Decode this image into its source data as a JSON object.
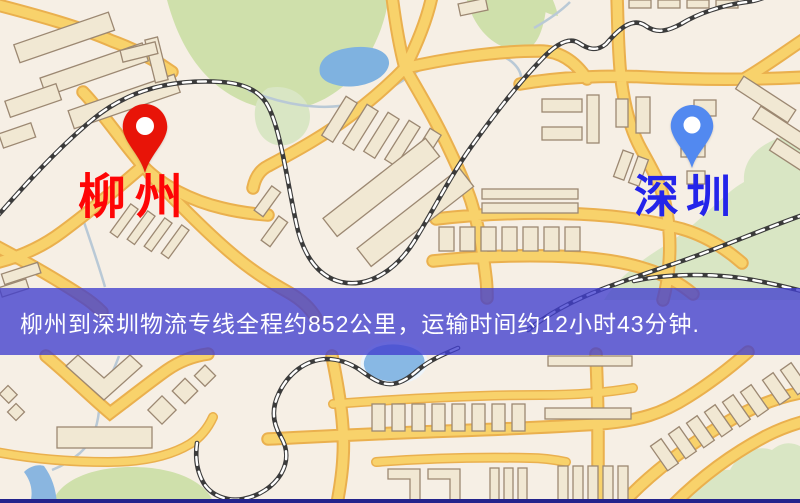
{
  "map": {
    "origin": {
      "label": "柳州",
      "pin_color": "#e81408",
      "label_color": "#fe0505",
      "pin_icon": "red-location-pin-icon"
    },
    "destination": {
      "label": "深圳",
      "pin_color": "#5289f0",
      "label_color": "#2424ea",
      "pin_icon": "blue-location-pin-icon"
    },
    "palette": {
      "background": "#f6efe5",
      "road_fill": "#f8d26b",
      "road_casing": "#eab04e",
      "building_fill": "#f1e8d3",
      "building_outline": "#9c8872",
      "park_green": "#cfe0ab",
      "hill_green": "#d9e6c4",
      "water_blue": "#7fb2e0",
      "railway_dark": "#3b3b3b",
      "stream_gray": "#b9c9d6"
    }
  },
  "banner": {
    "text": "柳州到深圳物流专线全程约852公里，运输时间约12小时43分钟.",
    "background_color": "rgba(64,62,206,0.78)",
    "text_color": "#ffffff",
    "distance_km": "852",
    "duration_hours": "12",
    "duration_minutes": "43"
  },
  "footer": {
    "strip_color": "#23238c"
  }
}
